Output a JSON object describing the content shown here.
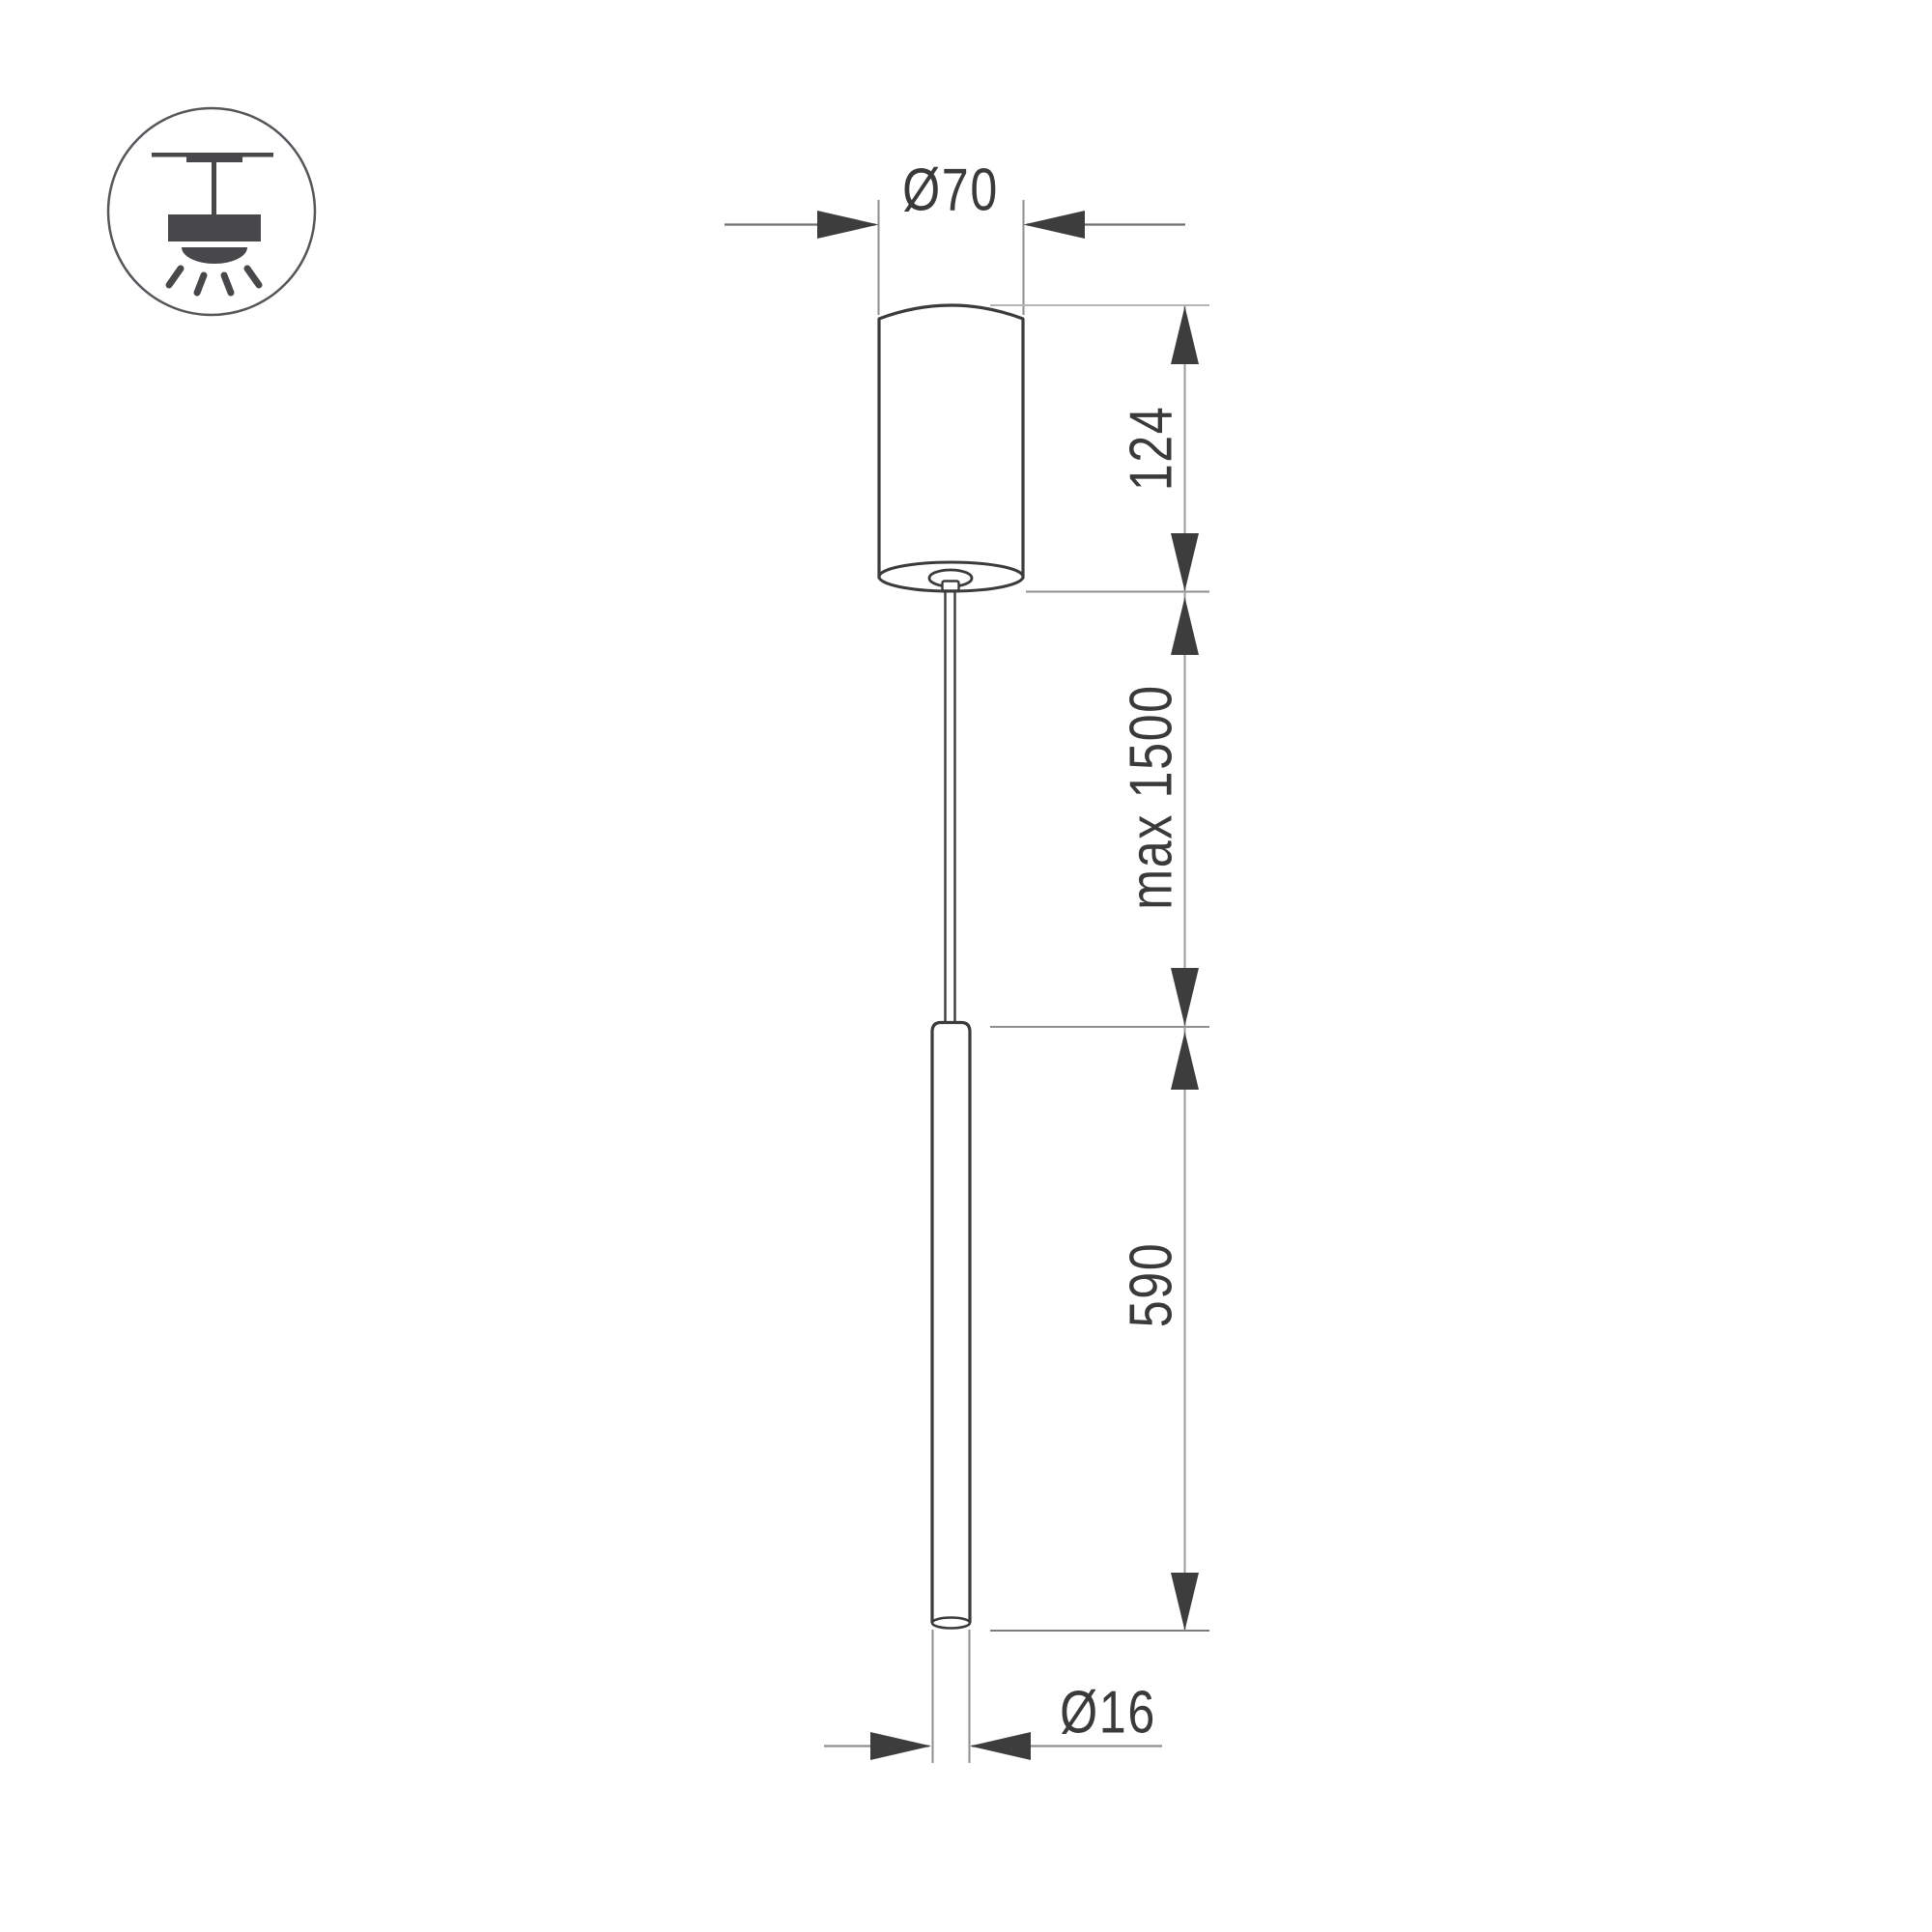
{
  "title": "Pendant luminaire dimension drawing",
  "icon": {
    "name": "ceiling-pendant-light-symbol"
  },
  "dimensions": {
    "canopy_diameter_label": "Ø70",
    "canopy_height_label": "124",
    "suspension_length_label": "max 1500",
    "tube_length_label": "590",
    "tube_diameter_label": "Ø16"
  },
  "colors": {
    "background": "#ffffff",
    "outline": "#3b3b3b",
    "arrow": "#3d3d3d",
    "text": "#3a3a3a",
    "dimension_line": "#8e8e8e",
    "light_extension_line": "#b5b5b5",
    "icon": "#48484b"
  }
}
